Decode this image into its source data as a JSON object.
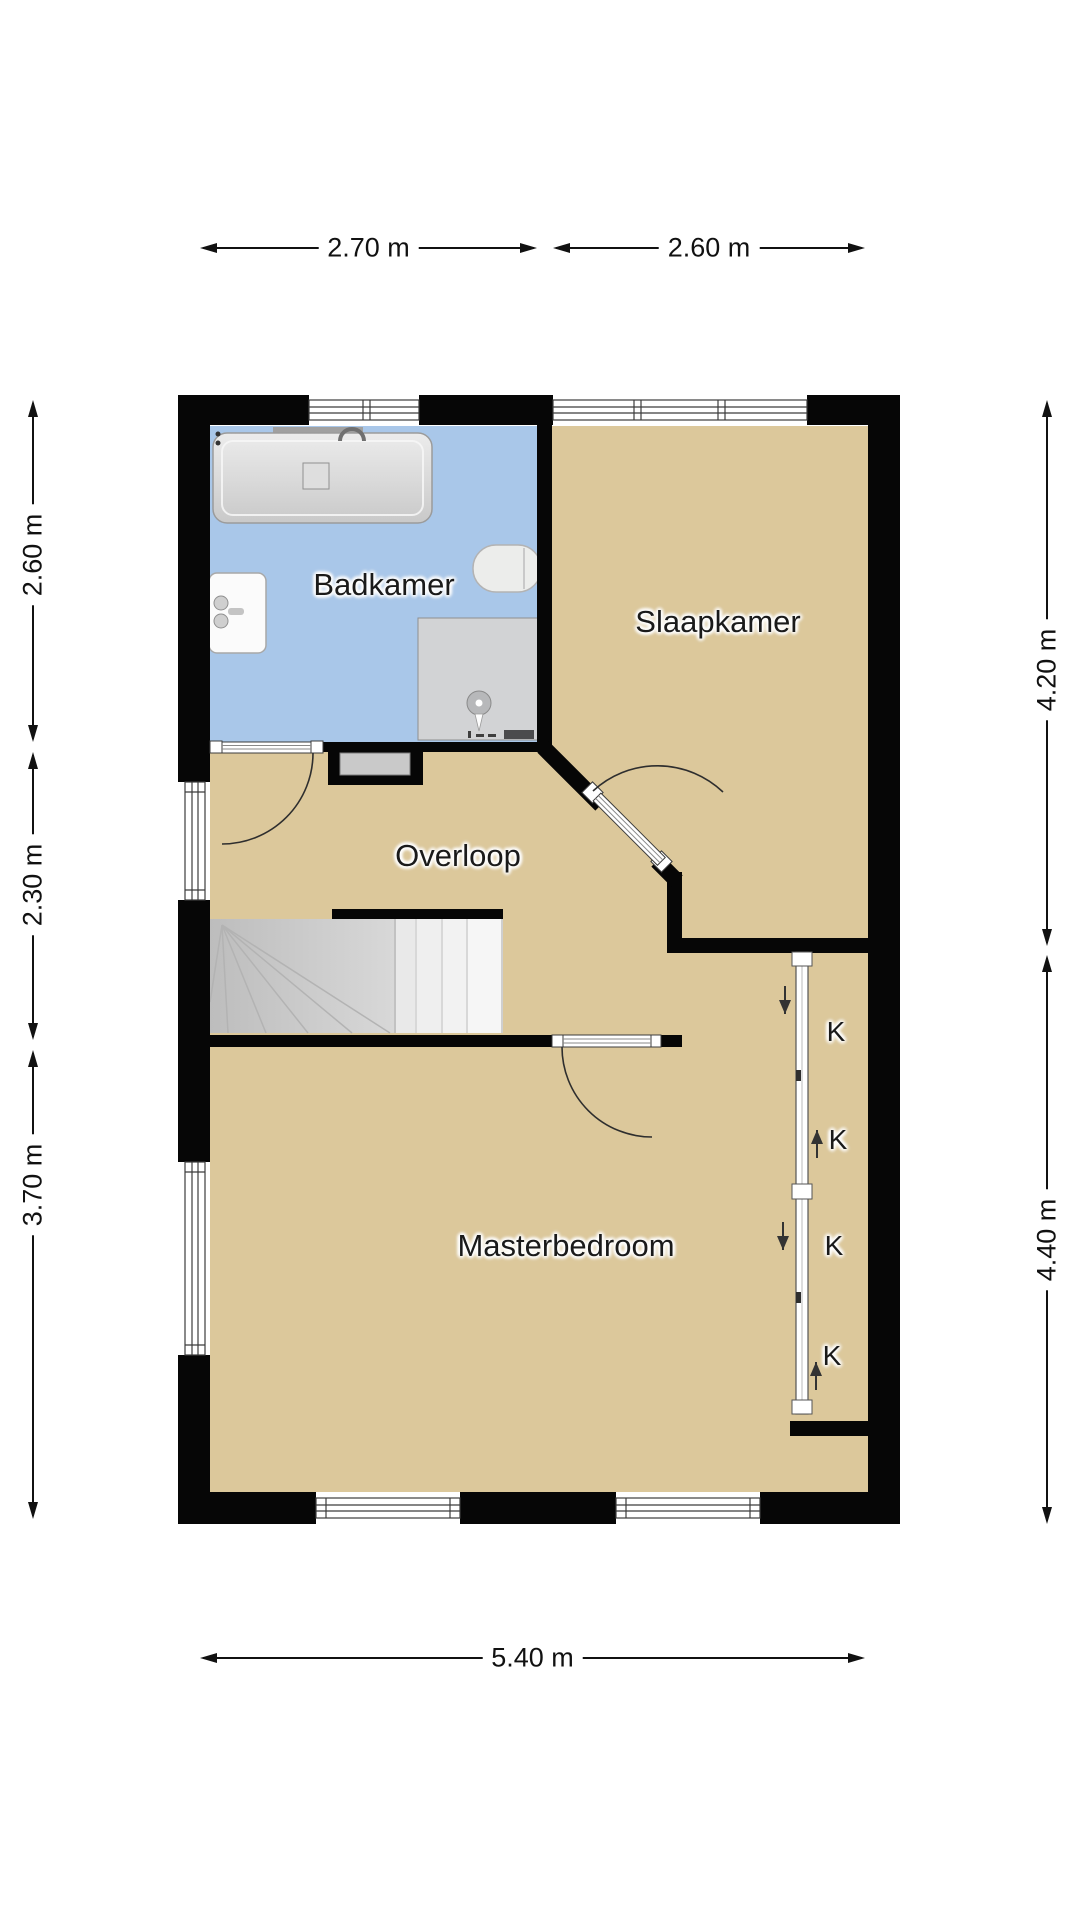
{
  "colors": {
    "floor_tan": "#dcc89b",
    "floor_blue": "#a9c7e9",
    "wall": "#060606",
    "stair_gray": "#c8c8c8",
    "text": "#1a1a1a"
  },
  "rooms": {
    "badkamer": "Badkamer",
    "slaapkamer": "Slaapkamer",
    "overloop": "Overloop",
    "masterbedroom": "Masterbedroom"
  },
  "closets": {
    "k1": "K",
    "k2": "K",
    "k3": "K",
    "k4": "K"
  },
  "dimensions": {
    "top_left": "2.70 m",
    "top_right": "2.60 m",
    "bottom": "5.40 m",
    "left_top": "2.60 m",
    "left_middle": "2.30 m",
    "left_bottom": "3.70 m",
    "right_top": "4.20 m",
    "right_bottom": "4.40 m"
  }
}
